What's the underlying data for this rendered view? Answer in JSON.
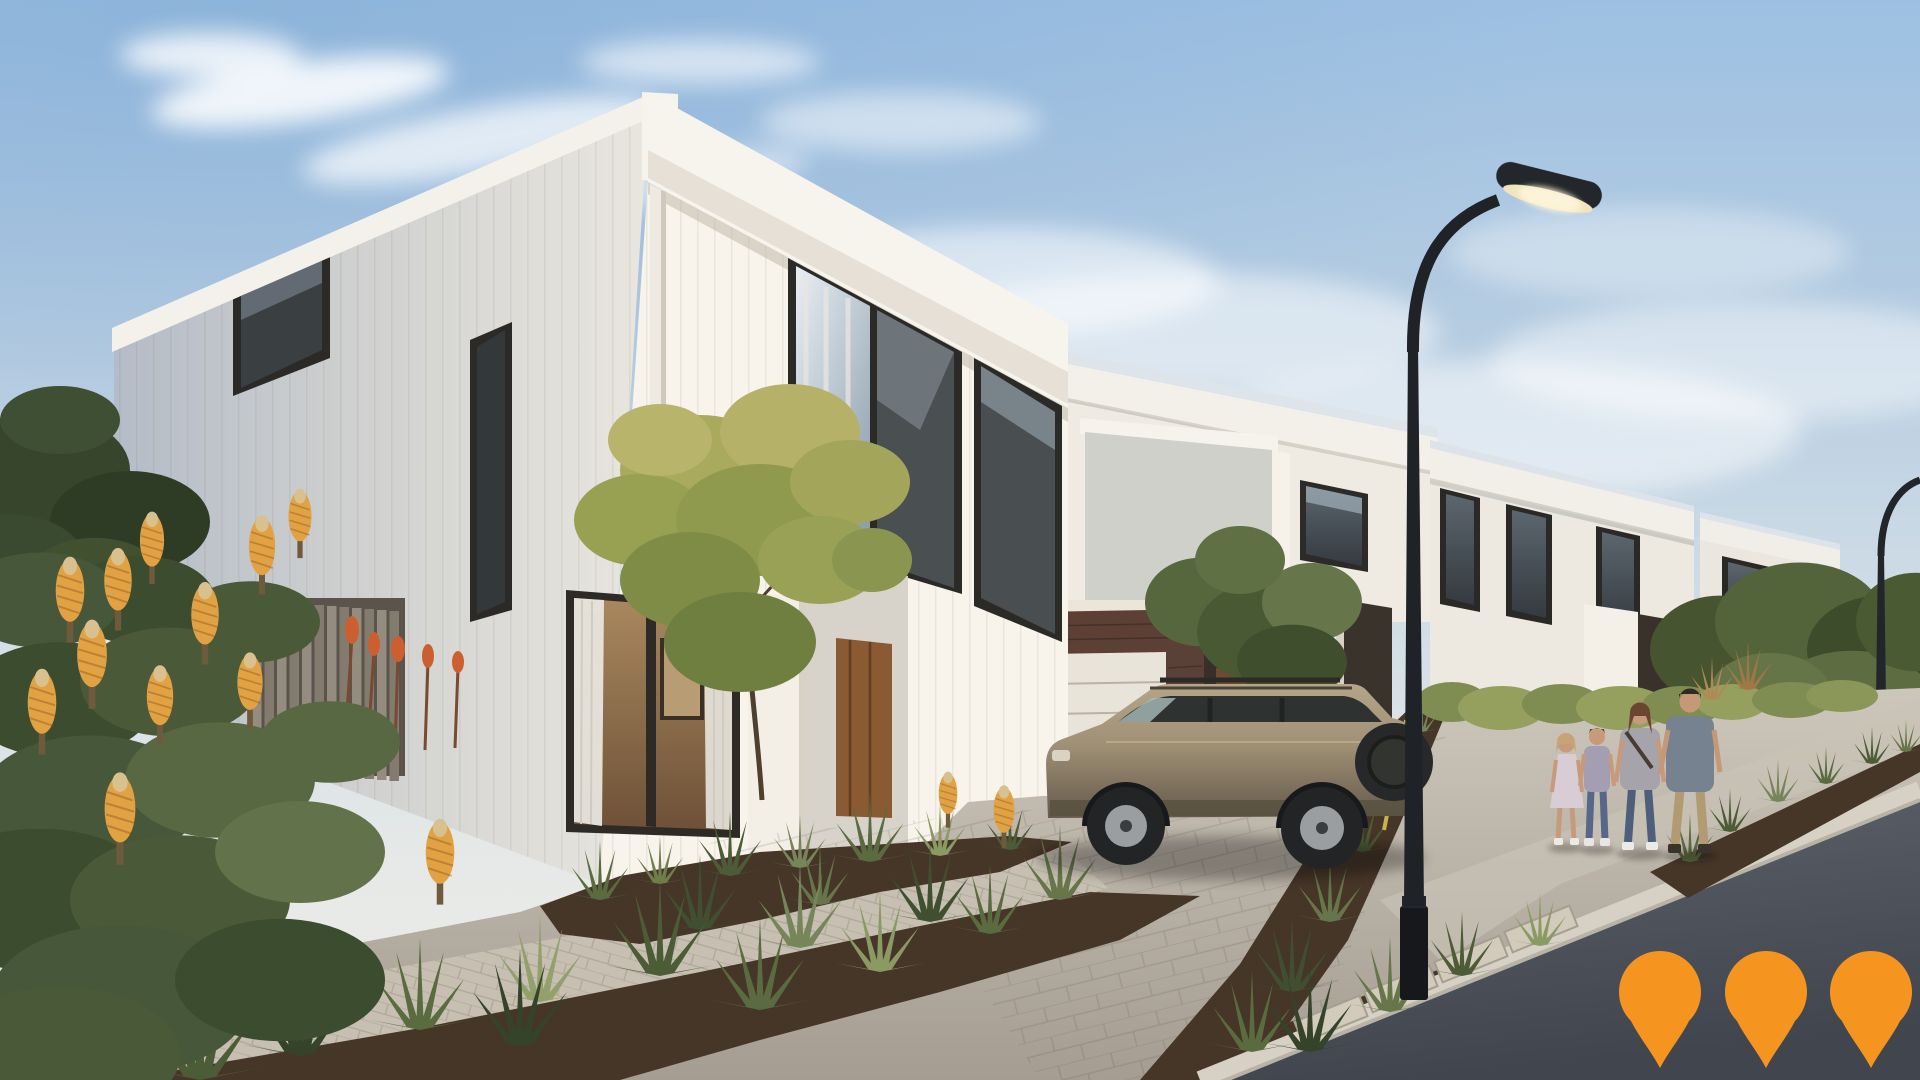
{
  "scene": {
    "title": "Townhouse development streetscape render",
    "description": "Photorealistic render of a row of modern two-storey white townhouses with dark-framed windows and skillion roofs, native gardens with orange banksia flowers and grassy tufts, paved driveways and footpaths, a champagne SUV parked in front of a garage, a family of four walking along the footpath, curved black street lights and a partly cloudy blue sky. Three orange location pins overlay the road in the bottom right corner.",
    "sky": {
      "top": "#9dc0e2",
      "mid": "#cfdce6",
      "horizon": "#edece6",
      "cloud": "#ffffff"
    },
    "palette": {
      "wall_lit": "#f8f4ec",
      "wall_shadow": "#b4bcc7",
      "fascia": "#f4f1ea",
      "window_frame": "#2c2a26",
      "glass_sky": "#b9c5cf",
      "interior_warm": "#9a7850",
      "brick": "#5c4036",
      "garage_door": "#e9e4da",
      "paving": "#b9b2a8",
      "footpath": "#c6bfb2",
      "curb": "#d6d0c5",
      "road": "#4c525a",
      "mulch": "#463628",
      "foliage_dark": "#3c4c2e",
      "foliage_light": "#8a9a62",
      "tree_yellow": "#a9aa5e",
      "banksia_flower": "#e1a244",
      "fence_timber": "#8f8779",
      "lamp_pole": "#1f2226",
      "car_body": "#a09176"
    },
    "objects": [
      "background-house",
      "main-townhouse",
      "middle-townhouse",
      "third-townhouse",
      "fourth-townhouse",
      "street-lamp",
      "distant-street-lamp",
      "suv-parked",
      "family-of-four",
      "banksia-garden",
      "timber-slat-fence",
      "paver-driveway",
      "footpath",
      "road"
    ]
  },
  "overlay": {
    "pin_icon": "location-pin-icon",
    "pin_count": 3,
    "pin_color": "#F69420"
  }
}
